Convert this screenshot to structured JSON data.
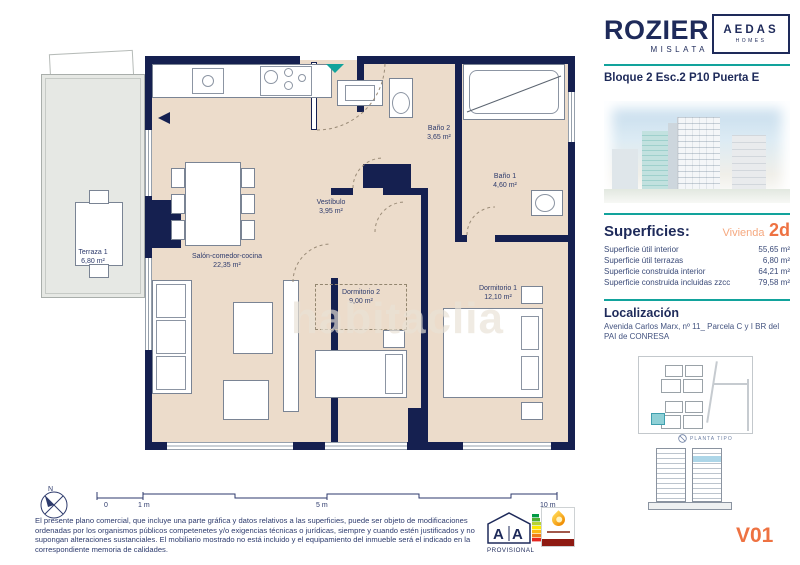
{
  "colors": {
    "navy_text": "#1e2a5a",
    "wall_navy": "#152050",
    "floor_beige": "#ecdccb",
    "terrace_gray": "#e6e8e4",
    "teal_accent": "#12a39c",
    "orange_accent": "#ee7242",
    "orange_light": "#f5a87f"
  },
  "header": {
    "brand": "ROZIER",
    "brand_sub": "MISLATA",
    "partner_line1": "AEDAS",
    "partner_line2": "HOMES",
    "unit_title": "Bloque 2 Esc.2 P10 Puerta E"
  },
  "superficies": {
    "heading": "Superficies:",
    "vivienda_label": "Vivienda",
    "vivienda_value": "2d",
    "rows": [
      {
        "label": "Superficie útil interior",
        "value": "55,65 m²"
      },
      {
        "label": "Superficie útil terrazas",
        "value": "6,80 m²"
      },
      {
        "label": "Superficie construida interior",
        "value": "64,21 m²"
      },
      {
        "label": "Superficie construida incluidas zzcc",
        "value": "79,58 m²"
      }
    ]
  },
  "localizacion": {
    "heading": "Localización",
    "address": "Avenida Carlos Marx, nº 11_ Parcela C y I BR del PAI de CONRESA"
  },
  "plan": {
    "watermark": "habitaclia",
    "rooms": {
      "terraza": {
        "name": "Terraza 1",
        "area": "6,80 m²"
      },
      "salon": {
        "name": "Salón-comedor-cocina",
        "area": "22,35 m²"
      },
      "vestibulo": {
        "name": "Vestíbulo",
        "area": "3,95 m²"
      },
      "bano2": {
        "name": "Baño 2",
        "area": "3,65 m²"
      },
      "bano1": {
        "name": "Baño 1",
        "area": "4,60 m²"
      },
      "dorm2": {
        "name": "Dormitorio 2",
        "area": "9,00 m²"
      },
      "dorm1": {
        "name": "Dormitorio 1",
        "area": "12,10 m²"
      }
    }
  },
  "site_plan": {
    "caption": "PLANTA TIPO"
  },
  "scale_bar": {
    "labels": [
      "0",
      "1 m",
      "5 m",
      "10 m"
    ],
    "compass_n": "N"
  },
  "disclaimer": "El presente plano comercial, que incluye una parte gráfica y datos relativos a las superficies, puede ser objeto de modificaciones ordenadas por los organismos públicos competenetes y/o exigencias técnicas o jurídicas, siempre y cuando estén justificados y no supongan alteraciones sustanciales. El mobiliario mostrado no está incluido y el equipamiento del inmueble será el indicado en la correspondiente memoria de calidades.",
  "energy": {
    "left": "A",
    "right": "A",
    "status": "PROVISIONAL"
  },
  "version": "V01"
}
